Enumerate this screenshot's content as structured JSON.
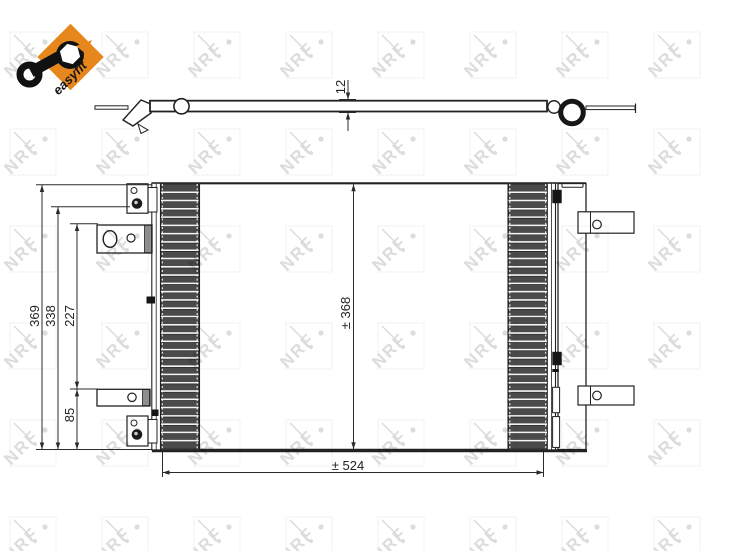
{
  "page": {
    "background": "#ffffff"
  },
  "badge": {
    "label": "easyfit",
    "color": "#e6871e",
    "icon": "wrench-icon",
    "text_color": "#141414"
  },
  "watermark": {
    "text": "NRF",
    "color": "#dcdcdc"
  },
  "drawing": {
    "line_color": "#222222",
    "fin_color": "#4a4a4a",
    "views": {
      "top": {
        "depth_dim": "12"
      },
      "front": {
        "overall_height_dim": "369",
        "upper_mount_dim": "338",
        "mount_span_dim": "227",
        "lower_mount_dim": "85",
        "core_height_dim": "± 368",
        "core_width_dim": "± 524"
      }
    }
  }
}
